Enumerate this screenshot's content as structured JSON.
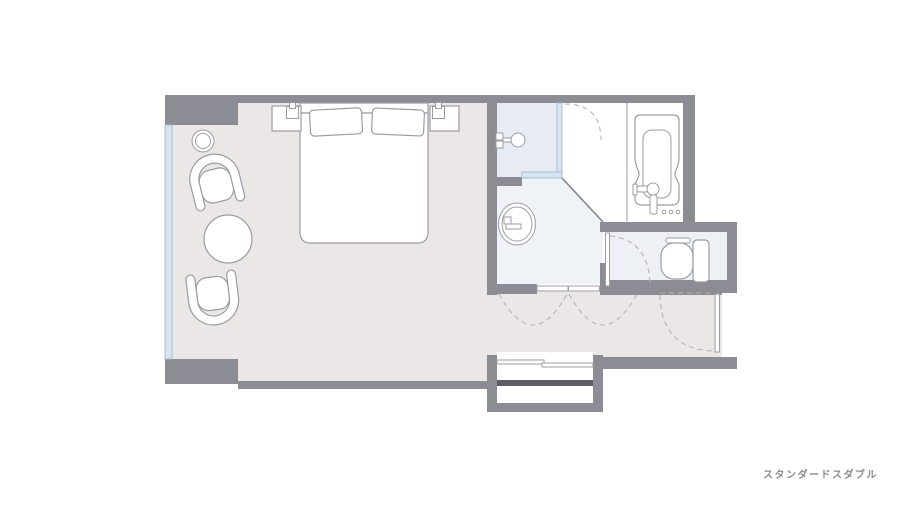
{
  "caption": "スタンダードスダブル",
  "colors": {
    "background": "#ffffff",
    "wall": "#8c8c95",
    "room_floor": "#ebe7e7",
    "shower_floor": "#e7ecf2",
    "wash_floor": "#eff2f6",
    "toilet_floor": "#edf1f5",
    "glass_fill": "#d8e5f0",
    "glass_stroke": "#a2bcd1",
    "outline": "#9c9ca4",
    "diag": "#84848d",
    "dash": "#b9b2b2",
    "step_bar": "#5e5e66",
    "text": "#8a8a8f"
  },
  "fixtures": [
    "double-bed",
    "pillow-left",
    "pillow-right",
    "nightstand-left",
    "nightstand-right",
    "reading-light-left",
    "reading-light-right",
    "floor-lamp",
    "armchair-top",
    "armchair-bottom",
    "round-table",
    "shower-head",
    "shower-glass-partition",
    "washbasin",
    "bathtub",
    "tub-faucet",
    "toilet",
    "toilet-door",
    "double-door",
    "entrance-door",
    "entrance-steps",
    "window"
  ]
}
